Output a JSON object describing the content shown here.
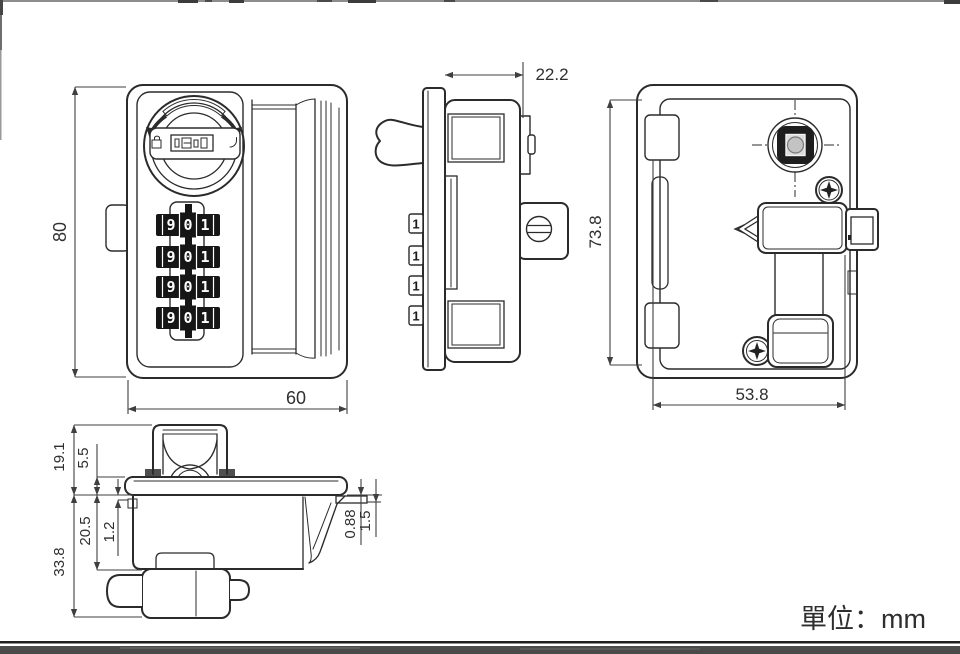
{
  "meta": {
    "unit_label": "單位：mm"
  },
  "dims": {
    "front_height": "80",
    "front_width": "60",
    "side_depth": "22.2",
    "back_height": "73.8",
    "back_width": "53.8",
    "top_upper_height": "19.1",
    "top_clip_height": "5.5",
    "top_body_depth": "20.5",
    "top_lip": "1.2",
    "top_total_height": "33.8",
    "top_edge_gap_a": "0.88",
    "top_edge_gap_b": "1.5"
  },
  "front": {
    "wheels": [
      {
        "digits": [
          "9",
          "0",
          "1"
        ]
      },
      {
        "digits": [
          "9",
          "0",
          "1"
        ]
      },
      {
        "digits": [
          "9",
          "0",
          "1"
        ]
      },
      {
        "digits": [
          "9",
          "0",
          "1"
        ]
      }
    ]
  },
  "side": {
    "tab_digits": [
      "1",
      "1",
      "1",
      "1"
    ]
  },
  "colors": {
    "line": "#2b2b2b",
    "wheel_black": "#161616",
    "footer_bar": "#4a4a4a"
  }
}
